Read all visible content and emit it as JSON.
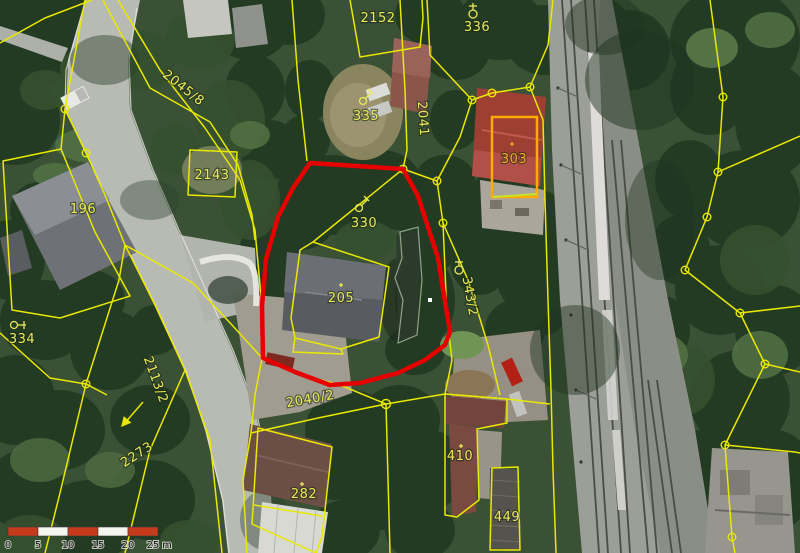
{
  "map": {
    "labels": {
      "l2152": "2152",
      "l336": "336",
      "l2045_8": "2045/8",
      "l2041": "2041",
      "l2143": "2143",
      "l196": "196",
      "l335": "335",
      "l303": "303",
      "l330": "330",
      "l205": "205",
      "l343_2": "343/2",
      "l334": "334",
      "l2113_2": "2113/2",
      "l2273": "2273",
      "l2040_2": "2040/2",
      "l282": "282",
      "l410": "410",
      "l449": "449"
    },
    "scale_bar": {
      "ticks": [
        "0",
        "5",
        "10",
        "15",
        "20",
        "25"
      ],
      "unit": "m"
    },
    "colors": {
      "parcel_line": "#e9e800",
      "selected_parcel": "#e60000",
      "building_303_outline": "#ffaa00",
      "scale_bar_red": "#c63b1e",
      "label_yellow": "#e9e957",
      "label_orange": "#f5a623"
    }
  }
}
